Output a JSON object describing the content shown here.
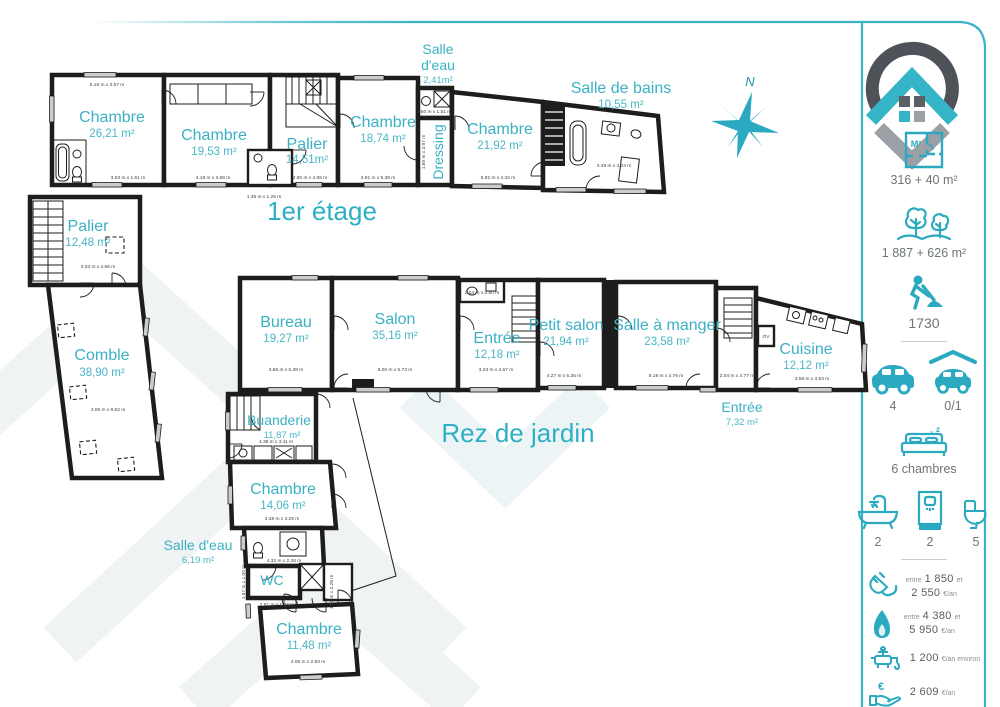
{
  "titles": {
    "floor1": "1er étage",
    "floor0": "Rez de jardin"
  },
  "compass": {
    "north": "N"
  },
  "rooms": {
    "f1": [
      {
        "name": "Chambre",
        "area": "26,21 m²",
        "dim1": "5.16 m x 3.57 m",
        "dim2": "3.53 m x 1.61 m"
      },
      {
        "name": "Chambre",
        "area": "19,53 m²",
        "dim1": "4.19 m x 3.68 m"
      },
      {
        "name": "Palier",
        "area": "14,51m²",
        "dim1": "2.80 m x 4.06 m",
        "dim2": "1.35 m x 1.25 m"
      },
      {
        "name": "Chambre",
        "area": "18,74 m²",
        "dim1": "3.91 m x 5.38 m"
      },
      {
        "name": "Salle",
        "name2": "d'eau",
        "area": "2,41m²",
        "dim1": "1.60 m x 1.51 m"
      },
      {
        "name": "Dressing",
        "dim1": "1.60 m x 3.97 m"
      },
      {
        "name": "Chambre",
        "area": "21,92 m²",
        "dim1": "5.92 m x 4.32 m"
      },
      {
        "name": "Salle de bains",
        "area": "10,55 m²",
        "dim1": "3.49 m x 3.04 m"
      },
      {
        "name": "Palier",
        "area": "12,48 m²",
        "dim1": "3.03 m x 4.66 m"
      },
      {
        "name": "Comble",
        "area": "38,90 m²",
        "dim1": "4.06 m x 9.62 m"
      }
    ],
    "f0": [
      {
        "name": "Bureau",
        "area": "19,27 m²",
        "dim1": "3.66 m x 5.38 m"
      },
      {
        "name": "Salon",
        "area": "35,16 m²",
        "dim1": "6.00 m x 5.73 m"
      },
      {
        "name": "Entrée",
        "area": "12,18 m²",
        "dim1": "3.23 m x 4.67 m",
        "dim2": "2.04 m x 0.80 m"
      },
      {
        "name": "Petit salon",
        "area": "21,94 m²",
        "dim1": "4.27 m x 5.35 m"
      },
      {
        "name": "Salle à manger",
        "area": "23,58 m²",
        "dim1": "5.19 m x 4.76 m"
      },
      {
        "name": "Entrée",
        "area": "7,32 m²",
        "dim1": "2.04 m x 4.77 m"
      },
      {
        "name": "Cuisine",
        "area": "12,12 m²",
        "dim1": "3.58 m x 3.53 m",
        "closet": "OV"
      },
      {
        "name": "Buanderie",
        "area": "11,87 m²",
        "dim1": "4.38 m x 3.11 m"
      },
      {
        "name": "Chambre",
        "area": "14,06 m²",
        "dim1": "4.38 m x 3.29 m"
      },
      {
        "name": "Salle d'eau",
        "area": "6,19 m²",
        "dim1": "4.32 m x 2.28 m"
      },
      {
        "name": "WC",
        "dim1": "2.81 m x 1.23 m",
        "dim2": "1.97 m x 1.00 m",
        "dim3": "1.55 m x 2.28 m"
      },
      {
        "name": "Chambre",
        "area": "11,48 m²",
        "dim1": "4.06 m x 2.93 m"
      }
    ]
  },
  "sidebar": {
    "surface_icon_label": "M²",
    "surface": "316 + 40 m²",
    "land": "1 887 + 626 m²",
    "year": "1730",
    "parking": "4",
    "garage": "0/1",
    "bedrooms": "6 chambres",
    "baths": "2",
    "showers": "2",
    "toilets": "5",
    "costs": [
      {
        "pre": "entre",
        "v1": "1 850",
        "mid": "et",
        "v2": "2 550",
        "unit": "€/an"
      },
      {
        "pre": "entre",
        "v1": "4 380",
        "mid": "et",
        "v2": "5 950",
        "unit": "€/an"
      },
      {
        "v1": "1 200",
        "unit": "€/an environ"
      },
      {
        "v1": "2 609",
        "unit": "€/an"
      }
    ]
  },
  "colors": {
    "accent": "#2fafc4",
    "dark": "#4d5358",
    "gray": "#9aa0a5",
    "wall": "#1d1d1b"
  }
}
